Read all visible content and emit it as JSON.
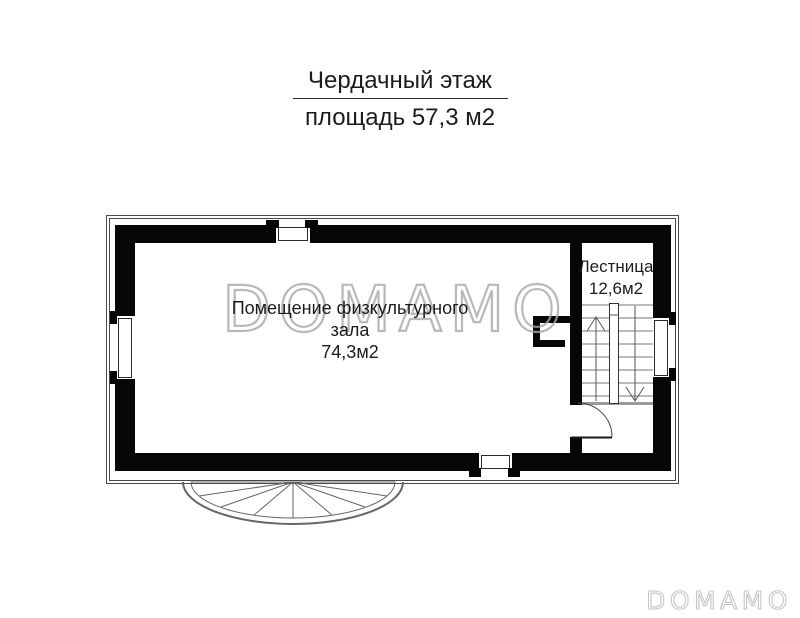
{
  "title": {
    "line1": "Чердачный этаж",
    "line2": "площадь 57,3 м2"
  },
  "plan": {
    "rooms": {
      "gym": {
        "label_line1": "Помещение физкультурного",
        "label_line2": "зала",
        "area": "74,3м2"
      },
      "stairwell": {
        "label": "Лестница",
        "area": "12,6м2"
      }
    }
  },
  "watermarks": {
    "center": "DOMAMO",
    "corner": "DOMAMO"
  },
  "colors": {
    "page_bg": "#ffffff",
    "wall": "#060606",
    "outline": "#4a4a4a",
    "stair_lines": "#777777",
    "watermark": "#a8a8a8",
    "text": "#1c1c1c"
  }
}
